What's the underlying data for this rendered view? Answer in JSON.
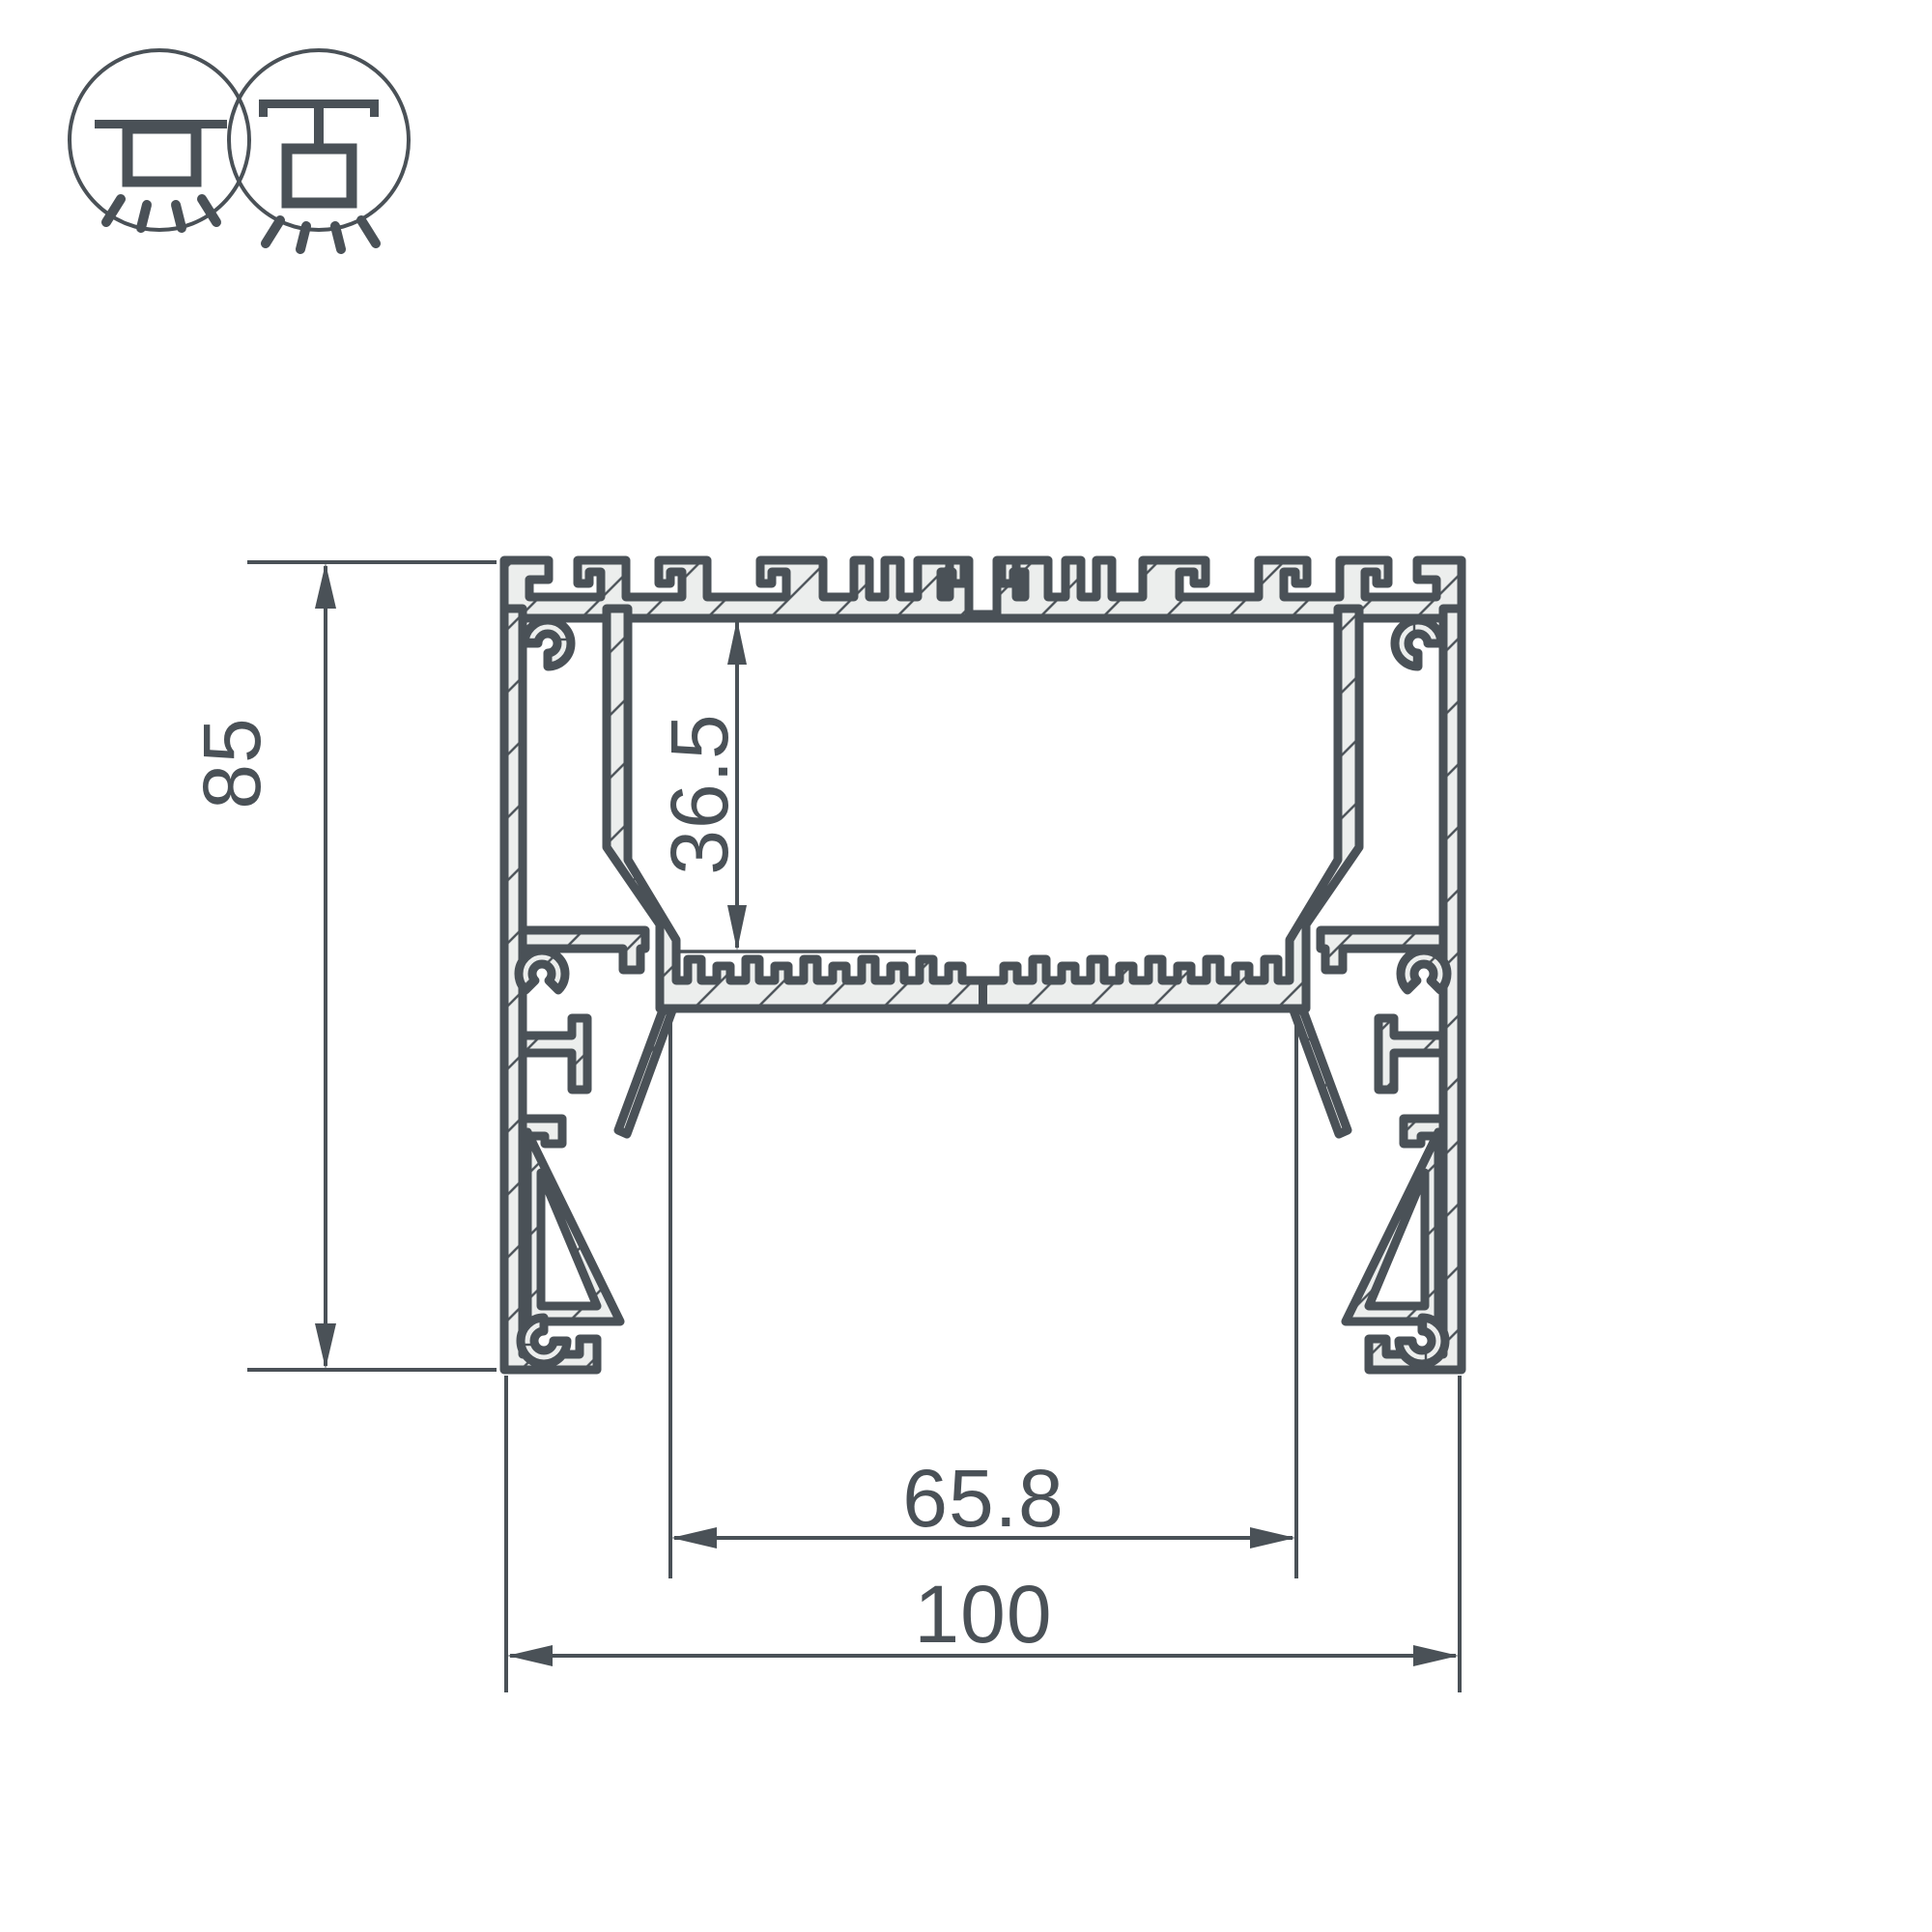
{
  "page": {
    "background": "#ffffff"
  },
  "drawing": {
    "title": "aluminum-led-profile-cross-section",
    "line_color": "#4a5157",
    "metal_fill": "#eceeed",
    "icons": [
      {
        "name": "surface-ceiling-mount"
      },
      {
        "name": "pendant-ceiling-mount"
      }
    ],
    "dimensions": {
      "overall_height": {
        "value": "85",
        "orientation": "vertical"
      },
      "inner_depth": {
        "value": "36.5",
        "orientation": "vertical"
      },
      "inner_width": {
        "value": "65.8",
        "orientation": "horizontal"
      },
      "overall_width": {
        "value": "100",
        "orientation": "horizontal"
      }
    }
  }
}
